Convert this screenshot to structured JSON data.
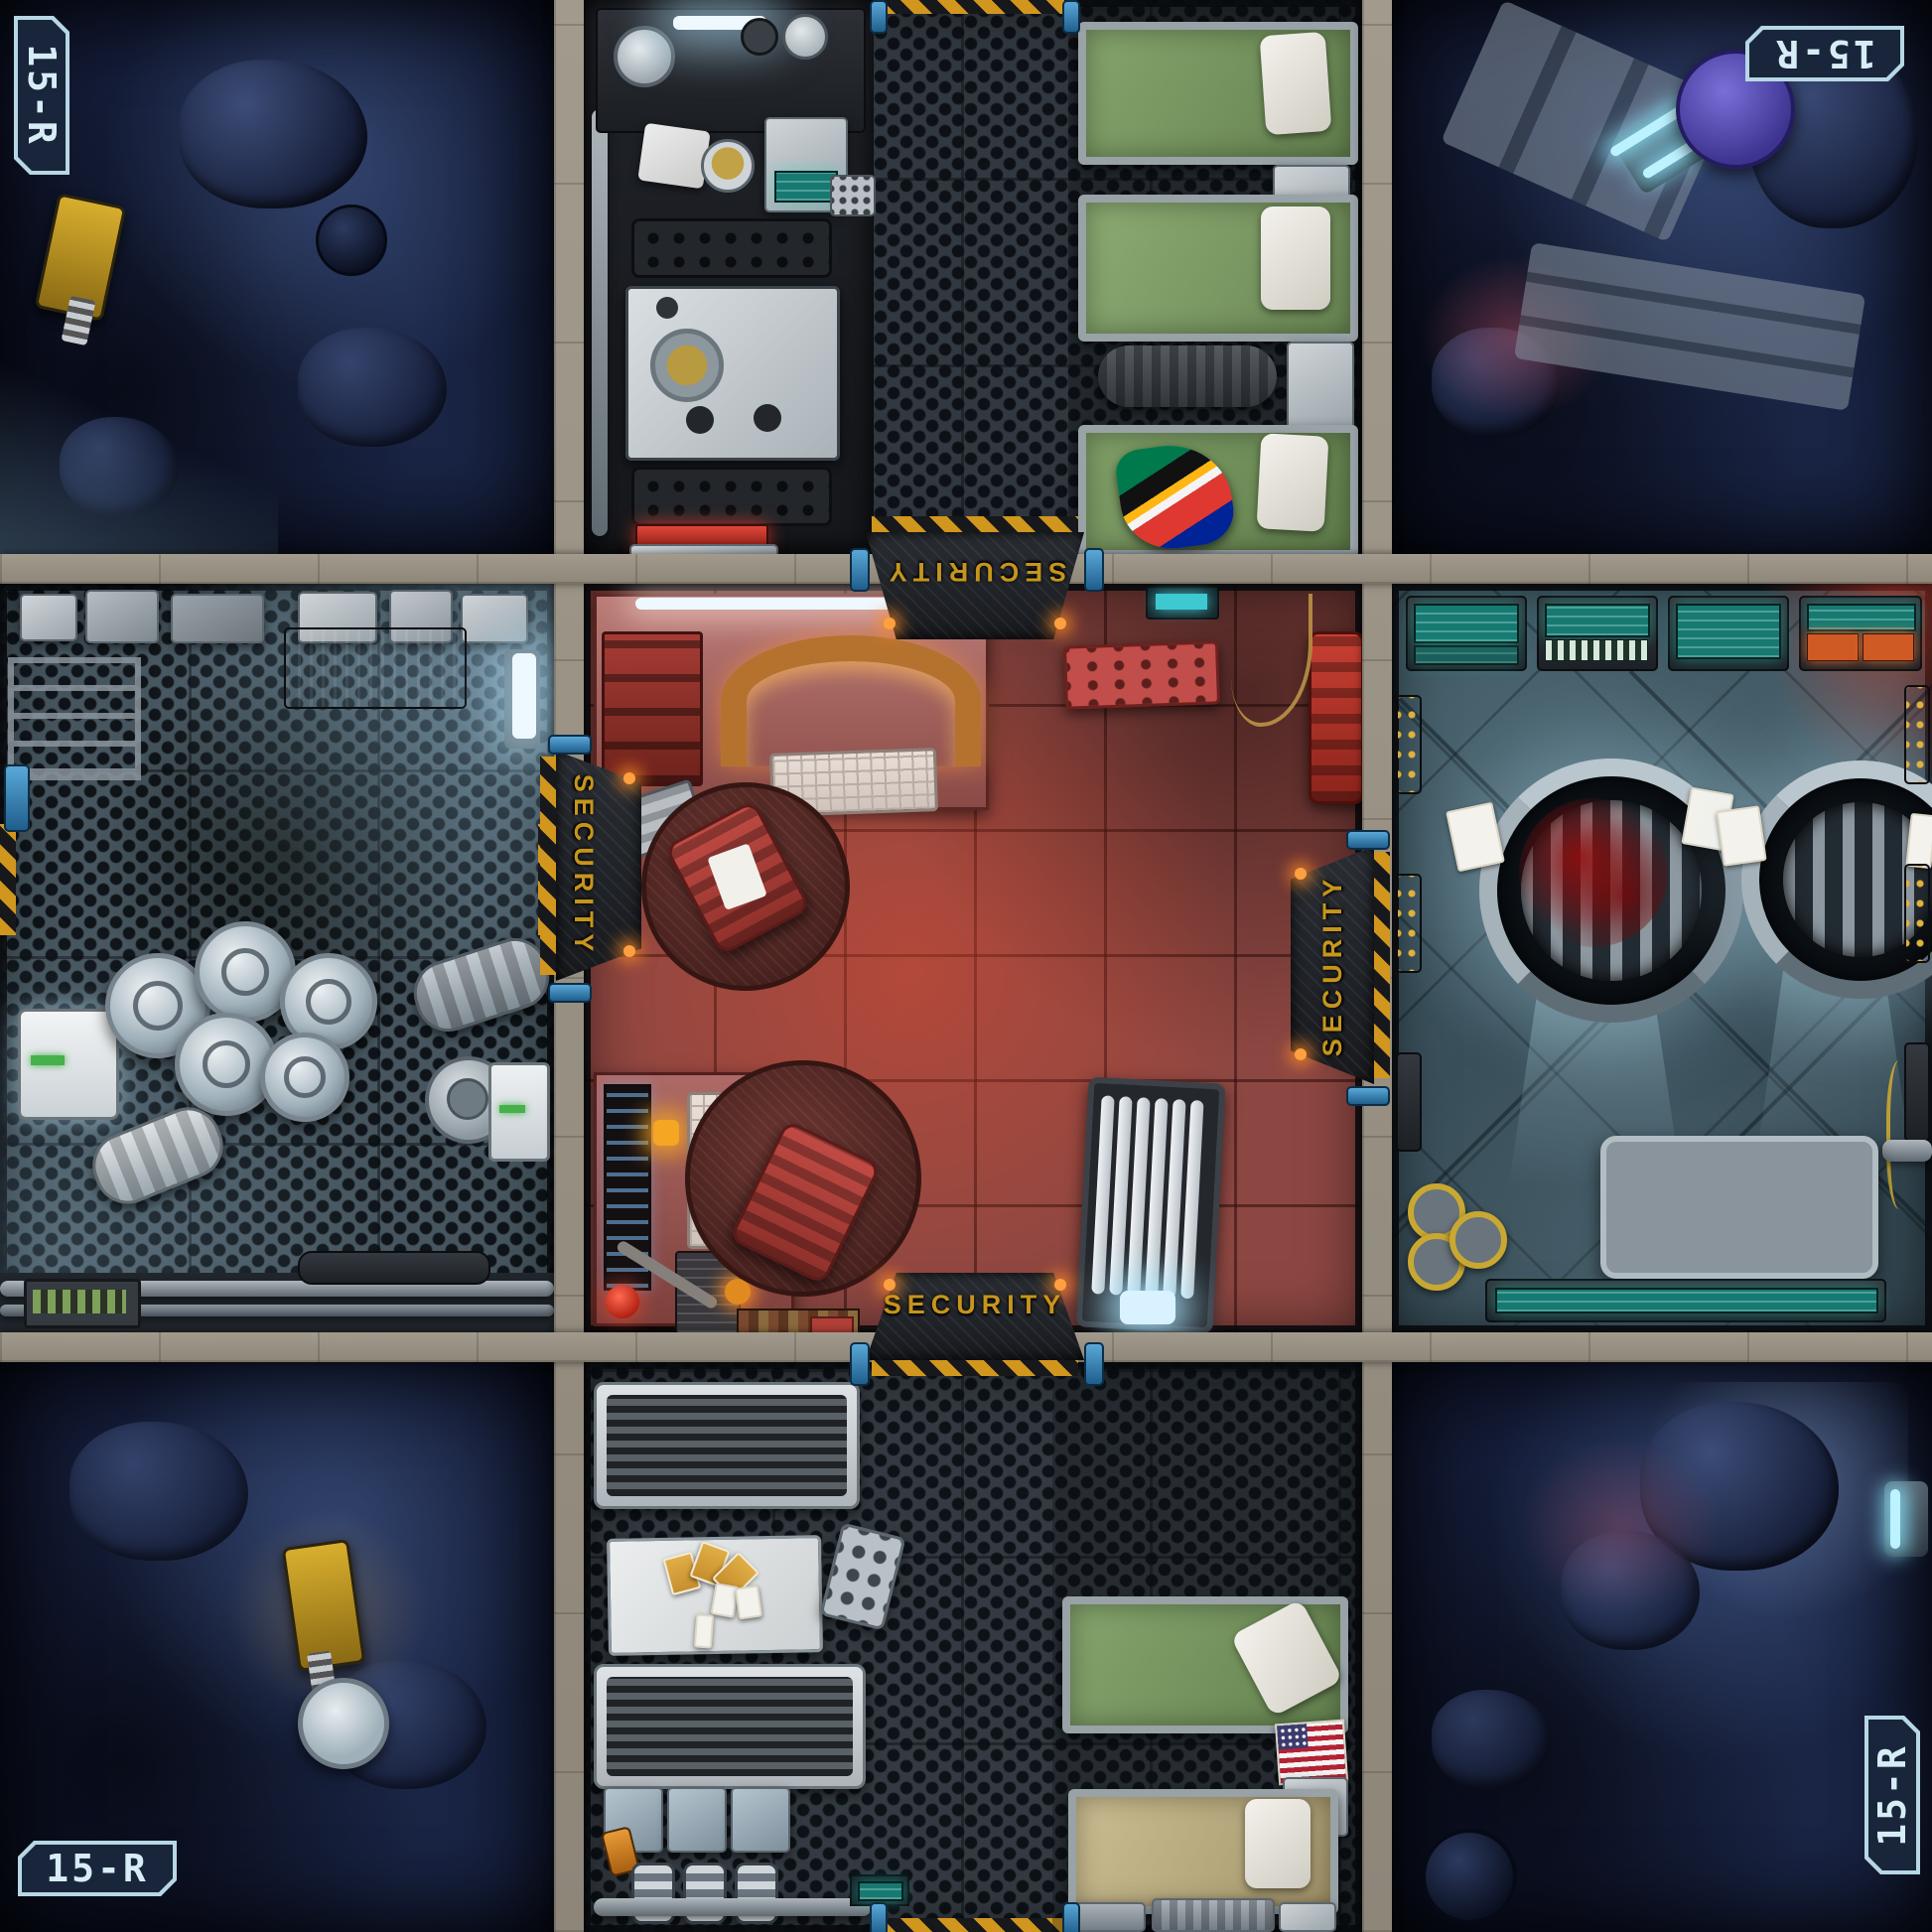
{
  "board": {
    "tile_set_id": "15-R",
    "center_room": "SECURITY"
  },
  "labels": {
    "badge_top_left": "15-R",
    "badge_top_right": "15-R",
    "badge_bottom_left": "15-R",
    "badge_bottom_right": "15-R",
    "door_top": "SECURITY",
    "door_bottom": "SECURITY",
    "door_left": "SECURITY",
    "door_right": "SECURITY"
  },
  "zones": {
    "top_left": "seabed-rocks",
    "top_center": "galley-and-bunks",
    "top_right": "seabed-wreckage",
    "middle_left": "storage-hold",
    "center": "security-room",
    "middle_right": "hatch-bay",
    "bottom_left": "seabed-rocks",
    "bottom_center": "mess-hall-and-bunks",
    "bottom_right": "seabed-rocks"
  },
  "colors": {
    "stone_border": "#968f82",
    "hazard_yellow": "#d1961e",
    "security_text": "#c5951d",
    "badge_text": "#d6edf6",
    "security_floor": "#8d4742",
    "rock_blue": "#121a33",
    "bed_green": "#7c9c66",
    "door_clamp_blue": "#2f81b5",
    "teal_screen": "#2a958e"
  }
}
